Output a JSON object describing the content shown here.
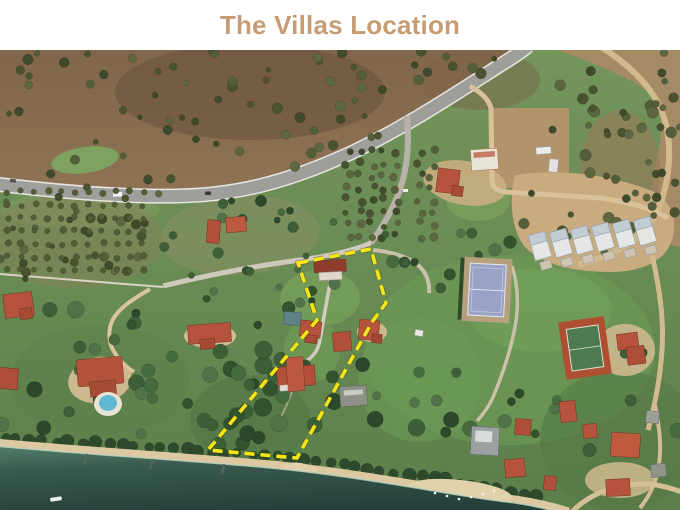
{
  "header": {
    "title": "The Villas Location"
  },
  "map": {
    "kind": "satellite-aerial-photo",
    "annotation": {
      "name": "property-boundary",
      "style": "dashed",
      "color": "#f6e414",
      "points": "298,213 371,199 386,253 372,272 297,408 208,400 317,270"
    },
    "palette": {
      "sea": "#2c4d44",
      "beach_sand": "#dcc9a1",
      "hillside_dirt": "#8a6e50",
      "grassland": "#6b8a57",
      "paved_road": "#9e9e9a",
      "dirt_road": "#d5bf97",
      "red_roof": "#b5533c",
      "tennis_court_blue": "#9aa2c6",
      "tennis_court_clay": "#ad4f30",
      "swimming_pool": "#5fb8d4",
      "title_text": "#c69d72"
    }
  }
}
